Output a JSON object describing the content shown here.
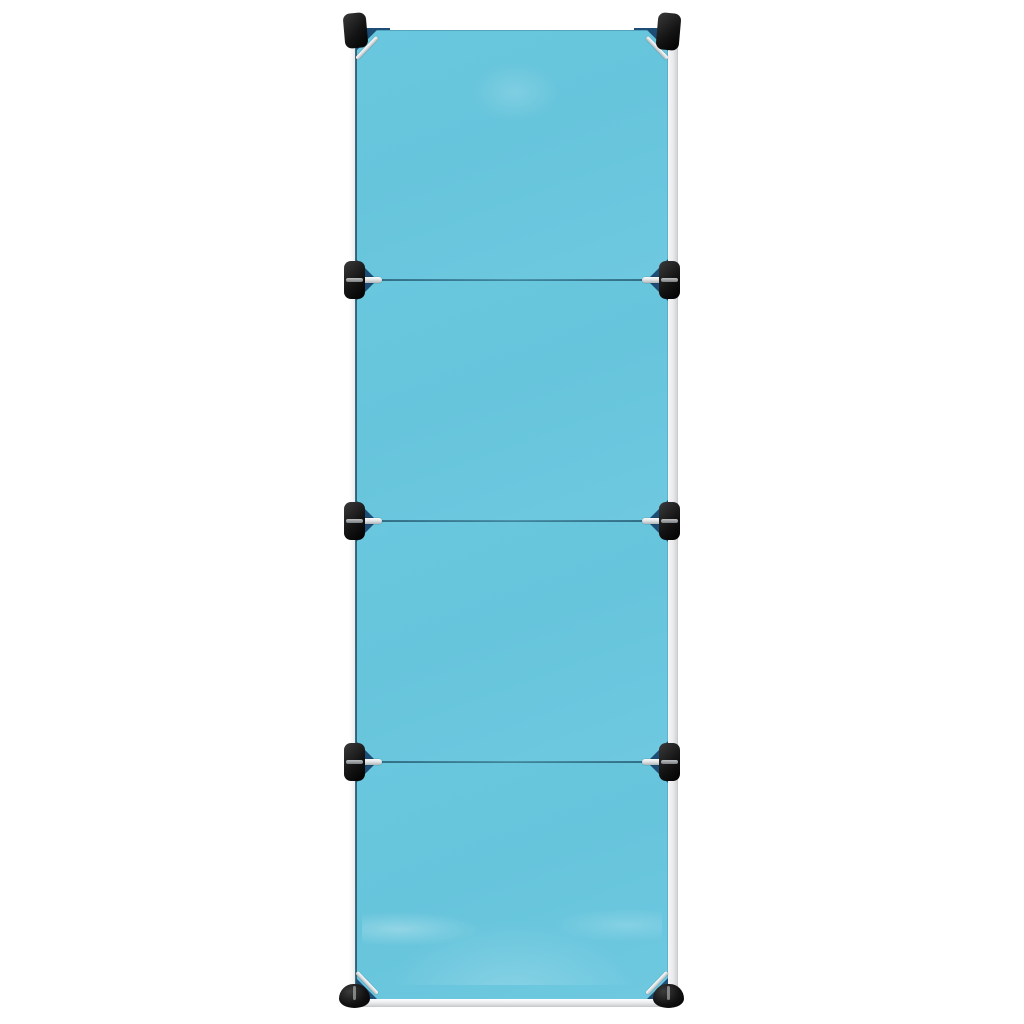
{
  "page": {
    "description": "Product photo of a kids' modular cube storage organiser, front view, single column of four cubes on a white background"
  },
  "product": {
    "type": "modular-cube-storage-organizer",
    "cube_count": 4,
    "view": "front",
    "column_count": 1
  },
  "colors": {
    "page_bg": "#ffffff",
    "panel": "#66c4db",
    "panel_edge": "#2f6b82",
    "chamfer": "#1d4c74",
    "connector": "#141414",
    "connector_highlight": "#3a3a3a",
    "rail": "#e9ebec",
    "rail_border": "#c9cbcc",
    "pin_light": "#fafafa",
    "pin_dark": "#aeb4b8"
  },
  "parts": {
    "door_panels": [
      "cube-door-1",
      "cube-door-2",
      "cube-door-3",
      "cube-door-4"
    ],
    "corner_connectors": 8,
    "feet": 2,
    "seams": 3
  }
}
